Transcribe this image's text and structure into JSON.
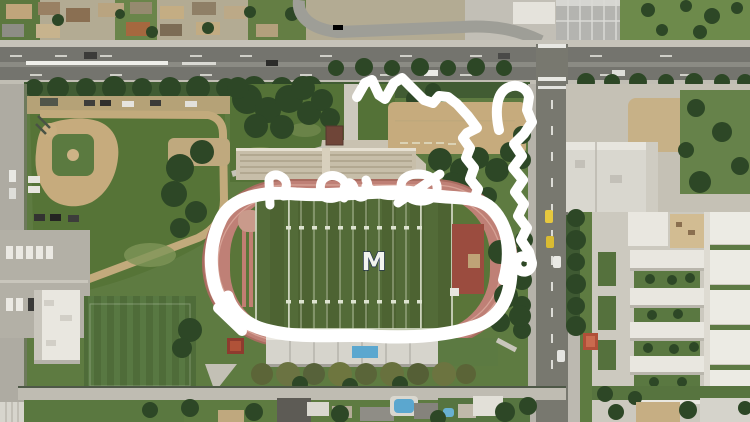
{
  "scene": {
    "description": "Aerial satellite view of a high-school campus: a football stadium with running track at center (circled by a hand-drawn white marker), baseball field at upper left, classroom buildings at right, residential streets along the top and bottom edges.",
    "stadium": {
      "logo": "M"
    }
  },
  "annotation": {
    "color": "#ffffff",
    "marks": [
      {
        "name": "oval-around-track",
        "shape": "thick freehand oval circling the football field and track"
      },
      {
        "name": "scribble-letters",
        "shape": "illegible cursive scribble along the top edge of the oval"
      },
      {
        "name": "zigzag-outline",
        "shape": "zigzag freehand line over the dirt practice field, north-east of the stadium"
      },
      {
        "name": "wavy-line-along-road",
        "shape": "wavy vertical stroke following the cross street, ending in a small hook"
      }
    ]
  },
  "palette": {
    "grass": "#5e7b41",
    "grasslight": "#7d9456",
    "turf": "#4d6332",
    "turfstripe": "#536b38",
    "track": "#bf8076",
    "tracklane": "#d6a296",
    "maroon": "#9b4c3f",
    "dirt": "#c6ab7d",
    "asphalt": "#74746e",
    "concrete": "#c5c1b5",
    "building": "#e9e7e0",
    "tree": "#2d4726",
    "treeolive": "#5d6639",
    "hedge": "#415c33",
    "pool": "#5ba7cf",
    "caryellow": "#e6c83e",
    "marker": "#ffffff",
    "logonavy": "#1d2c4e",
    "logofill": "#f2f3ee"
  }
}
